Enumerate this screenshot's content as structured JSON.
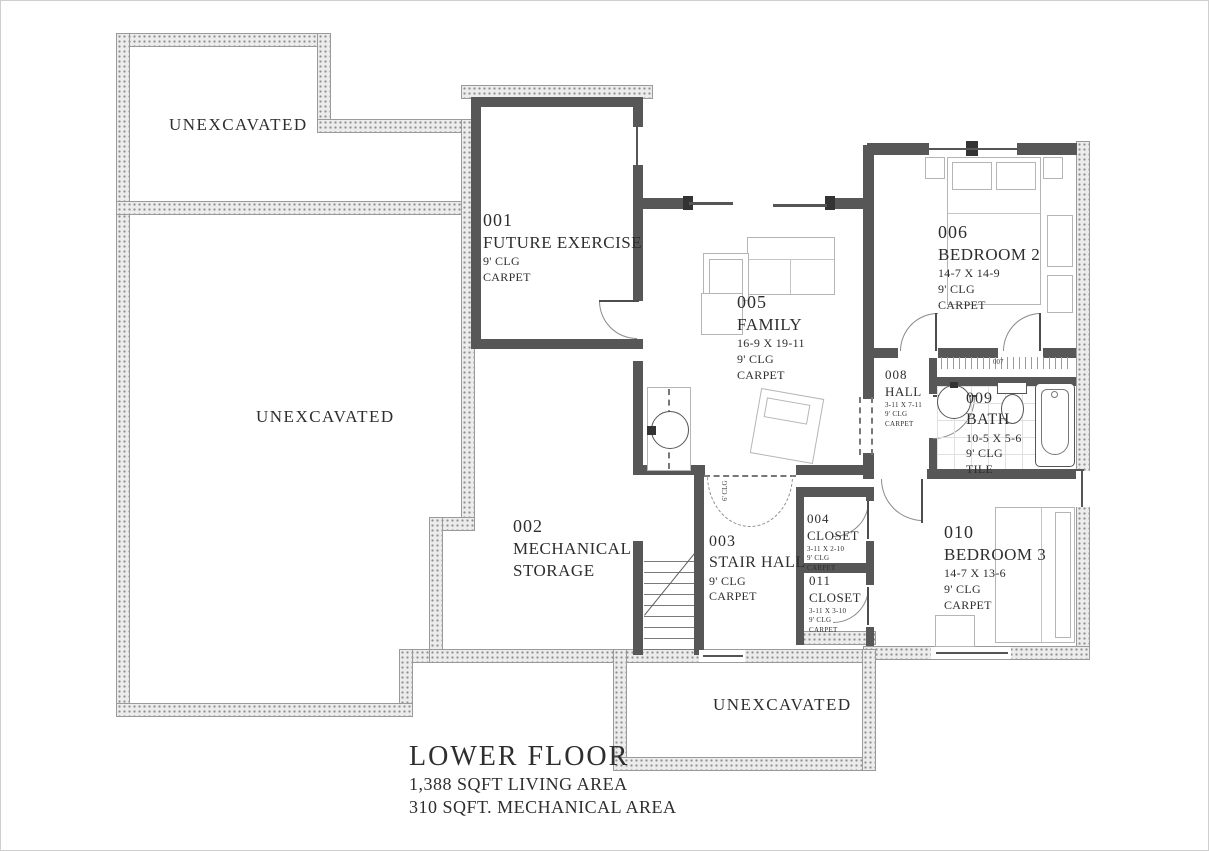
{
  "drawing": {
    "title": "LOWER FLOOR",
    "subtitle1": "1,388 SQFT LIVING AREA",
    "subtitle2": "310 SQFT. MECHANICAL AREA"
  },
  "areas": {
    "unexcavated_top": "UNEXCAVATED",
    "unexcavated_left": "UNEXCAVATED",
    "unexcavated_bottom": "UNEXCAVATED"
  },
  "labels": {
    "opening_clg": "6' CLG"
  },
  "rooms": {
    "r001": {
      "number": "001",
      "name": "FUTURE EXERCISE",
      "clg": "9' CLG",
      "floor": "CARPET"
    },
    "r002": {
      "number": "002",
      "name": "MECHANICAL",
      "name2": "STORAGE"
    },
    "r003": {
      "number": "003",
      "name": "STAIR HALL",
      "clg": "9' CLG",
      "floor": "CARPET"
    },
    "r004": {
      "number": "004",
      "name": "CLOSET",
      "dims": "3-11 X 2-10",
      "clg": "9' CLG",
      "floor": "CARPET"
    },
    "r005": {
      "number": "005",
      "name": "FAMILY",
      "dims": "16-9 X 19-11",
      "clg": "9' CLG",
      "floor": "CARPET"
    },
    "r006": {
      "number": "006",
      "name": "BEDROOM 2",
      "dims": "14-7 X 14-9",
      "clg": "9' CLG",
      "floor": "CARPET"
    },
    "r007": {
      "number": "007"
    },
    "r008": {
      "number": "008",
      "name": "HALL",
      "dims": "3-11 X 7-11",
      "clg": "9' CLG",
      "floor": "CARPET"
    },
    "r009": {
      "number": "009",
      "name": "BATH",
      "dims": "10-5 X 5-6",
      "clg": "9' CLG",
      "floor": "TILE"
    },
    "r010": {
      "number": "010",
      "name": "BEDROOM 3",
      "dims": "14-7 X 13-6",
      "clg": "9' CLG",
      "floor": "CARPET"
    },
    "r011": {
      "number": "011",
      "name": "CLOSET",
      "dims": "3-11 X 3-10",
      "clg": "9' CLG",
      "floor": "CARPET"
    }
  }
}
